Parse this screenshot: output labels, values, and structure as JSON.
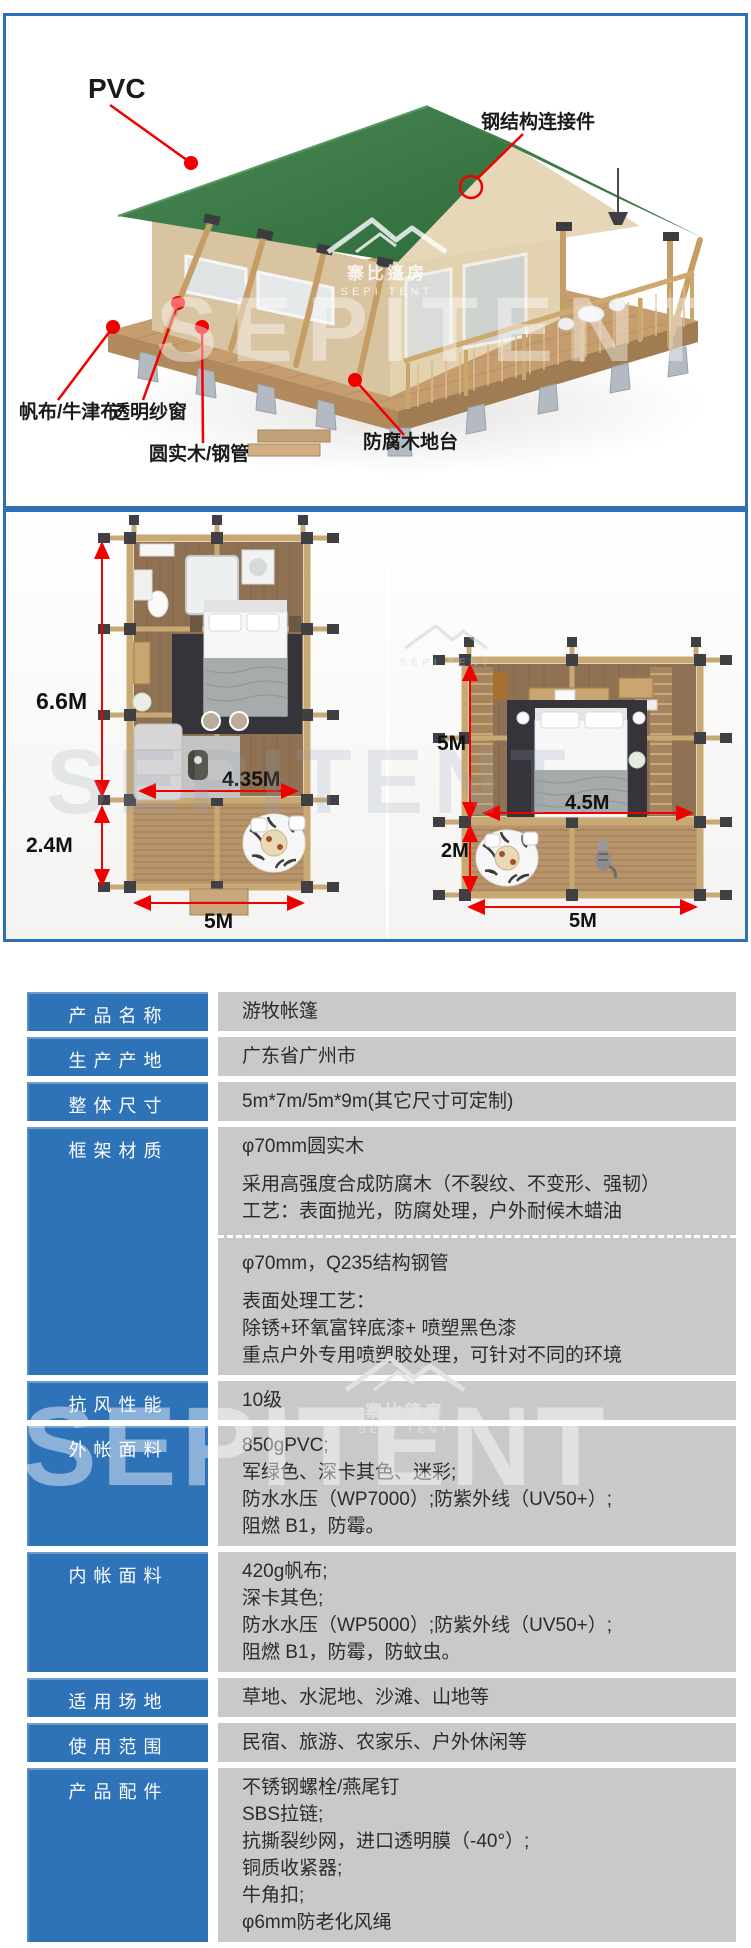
{
  "theme": {
    "accent_blue": "#2e6fb7",
    "table_label_bg": "#2e72b8",
    "table_value_bg": "#c9c9c9",
    "annotation_red": "#f10000",
    "roof_green": "#3f7f4b",
    "wall_beige": "#d8c4a0"
  },
  "brand": {
    "watermark": "SEPITENT",
    "logo_cn": "寨比篷房",
    "logo_en": "SEPI TENT"
  },
  "render_section": {
    "labels": {
      "pvc": "PVC",
      "steel_connector": "钢结构连接件",
      "canvas": "帆布/牛津布",
      "screen_window": "透明纱窗",
      "pole": "圆实木/钢管",
      "deck": "防腐木地台"
    }
  },
  "plans_section": {
    "left_plan": {
      "cabin_depth": "6.6M",
      "deck_depth": "2.4M",
      "inner_width": "4.35M",
      "total_width": "5M"
    },
    "right_plan": {
      "cabin_depth": "5M",
      "deck_depth": "2M",
      "inner_width": "4.5M",
      "total_width": "5M"
    }
  },
  "spec_table": {
    "rows": [
      {
        "label": "产品名称",
        "blocks": [
          [
            "游牧帐篷"
          ]
        ]
      },
      {
        "label": "生产产地",
        "blocks": [
          [
            "广东省广州市"
          ]
        ]
      },
      {
        "label": "整体尺寸",
        "blocks": [
          [
            "5m*7m/5m*9m(其它尺寸可定制)"
          ]
        ]
      },
      {
        "label": "框架材质",
        "blocks": [
          [
            "φ70mm圆实木",
            "",
            "采用高强度合成防腐木（不裂纹、不变形、强韧）",
            "工艺：表面抛光，防腐处理，户外耐候木蜡油"
          ],
          [
            "φ70mm，Q235结构钢管",
            "",
            "表面处理工艺：",
            "除锈+环氧富锌底漆+ 喷塑黑色漆",
            "重点户外专用喷塑胶处理，可针对不同的环境"
          ]
        ]
      },
      {
        "label": "抗风性能",
        "blocks": [
          [
            "10级"
          ]
        ]
      },
      {
        "label": "外帐面料",
        "blocks": [
          [
            "850gPVC;",
            "军绿色、深卡其色、迷彩;",
            "防水水压（WP7000）;防紫外线（UV50+）;",
            "阻燃 B1，防霉。"
          ]
        ]
      },
      {
        "label": "内帐面料",
        "blocks": [
          [
            "420g帆布;",
            "深卡其色;",
            "防水水压（WP5000）;防紫外线（UV50+）;",
            "阻燃 B1，防霉，防蚊虫。"
          ]
        ]
      },
      {
        "label": "适用场地",
        "blocks": [
          [
            "草地、水泥地、沙滩、山地等"
          ]
        ]
      },
      {
        "label": "使用范围",
        "blocks": [
          [
            "民宿、旅游、农家乐、户外休闲等"
          ]
        ]
      },
      {
        "label": "产品配件",
        "blocks": [
          [
            "不锈钢螺栓/燕尾钉",
            "SBS拉链;",
            "抗撕裂纱网，进口透明膜（-40°）;",
            "铜质收紧器;",
            "牛角扣;",
            "φ6mm防老化风绳"
          ]
        ]
      }
    ]
  }
}
